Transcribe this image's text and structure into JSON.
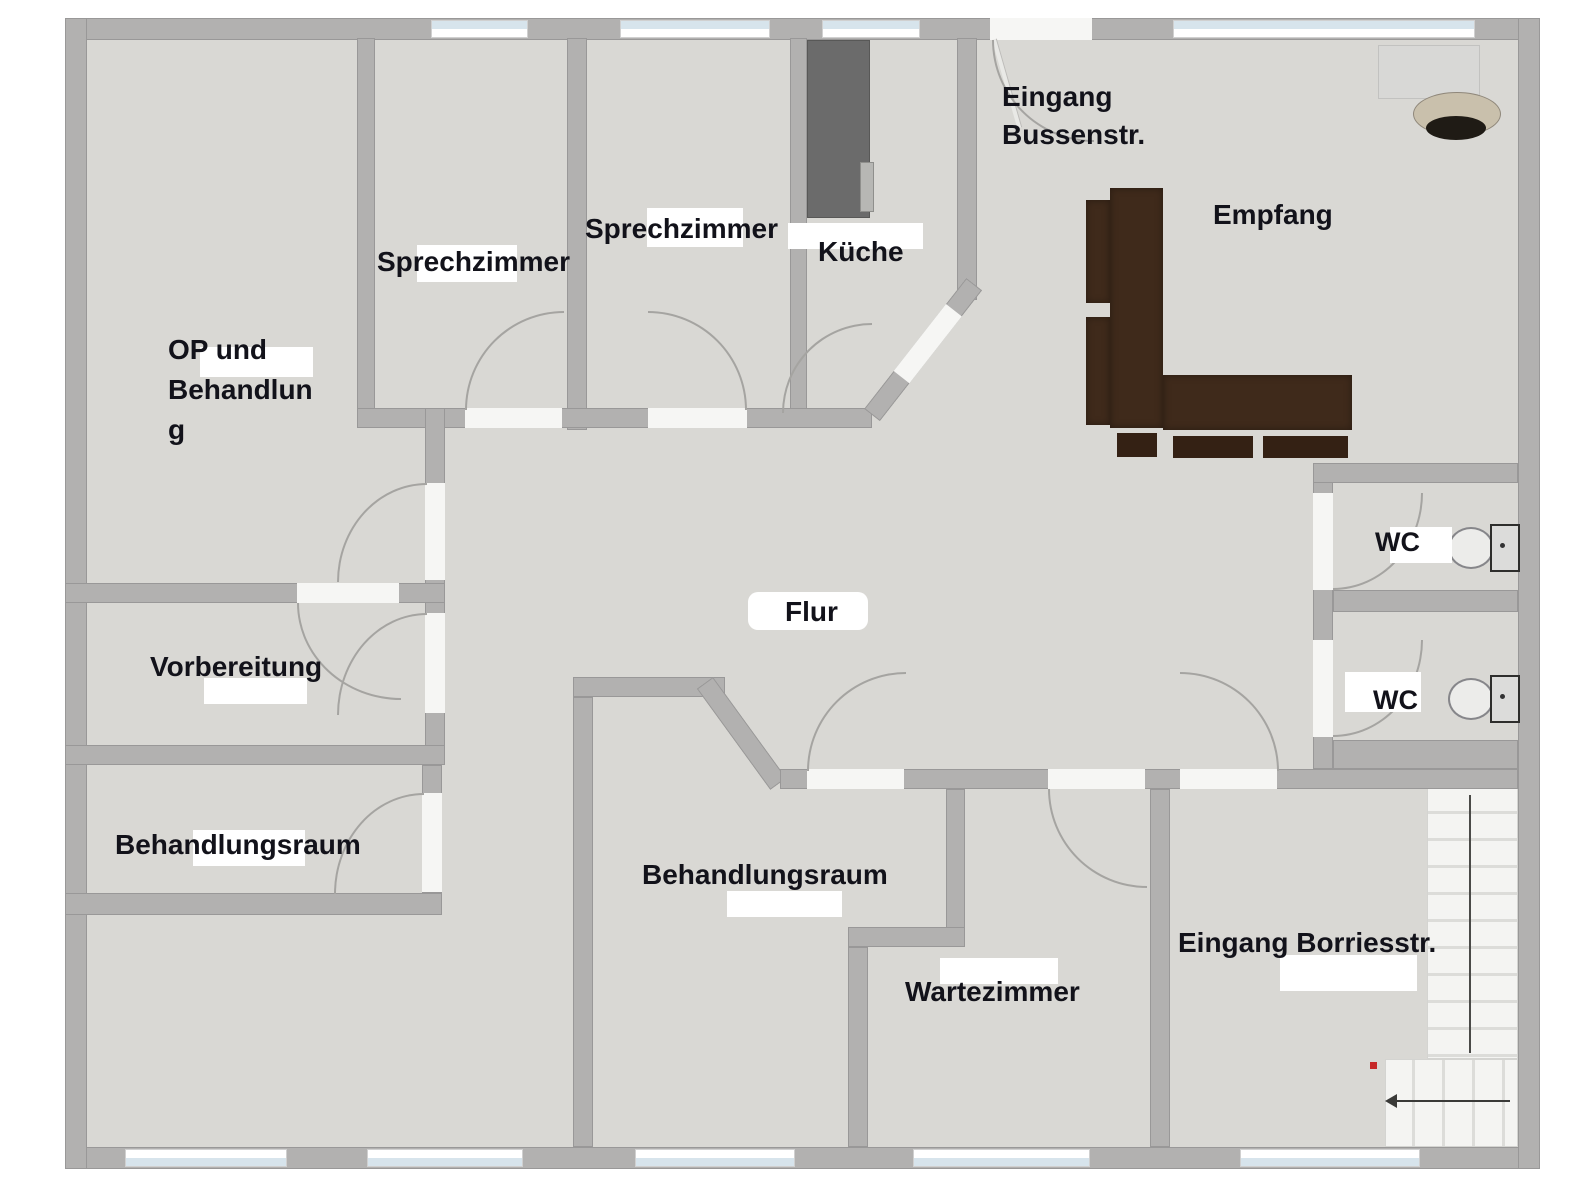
{
  "labels": {
    "op_1": "OP und",
    "op_2": "Behandlun",
    "op_3": "g",
    "sprechzimmer_links": "Sprechzimmer",
    "sprechzimmer_rechts": "Sprechzimmer",
    "kueche": "Küche",
    "eingang_bussenstr_1": "Eingang",
    "eingang_bussenstr_2": "Bussenstr.",
    "empfang": "Empfang",
    "flur": "Flur",
    "vorbereitung": "Vorbereitung",
    "behandlungsraum_links": "Behandlungsraum",
    "behandlungsraum_mitte": "Behandlungsraum",
    "wartezimmer": "Wartezimmer",
    "wc_oben": "WC",
    "wc_unten": "WC",
    "eingang_borriesstr": "Eingang Borriesstr."
  },
  "colors": {
    "floor": "#d9d8d4",
    "wall": "#b2b1b0",
    "opening": "#f6f6f4",
    "glass": "#d7e4ec",
    "arc": "#a5a4a1",
    "label_text": "#12121a",
    "label_bg": "#ffffff",
    "desk": "#3f2a1b",
    "desk_chair": "#342114",
    "cabinet": "#6b6b6b",
    "cabinet_handle": "#b7b7b4",
    "sideboard": "#d8d8d6",
    "chair_seat": "#c9c0ac",
    "chair_base": "#1f1b15",
    "toilet": "#ececea",
    "stair": "#f4f4f2",
    "stair_line": "#dcdcd9",
    "stair_guide": "#4a4a48",
    "arrow": "#3a3a38",
    "red_marker": "#c62828"
  }
}
